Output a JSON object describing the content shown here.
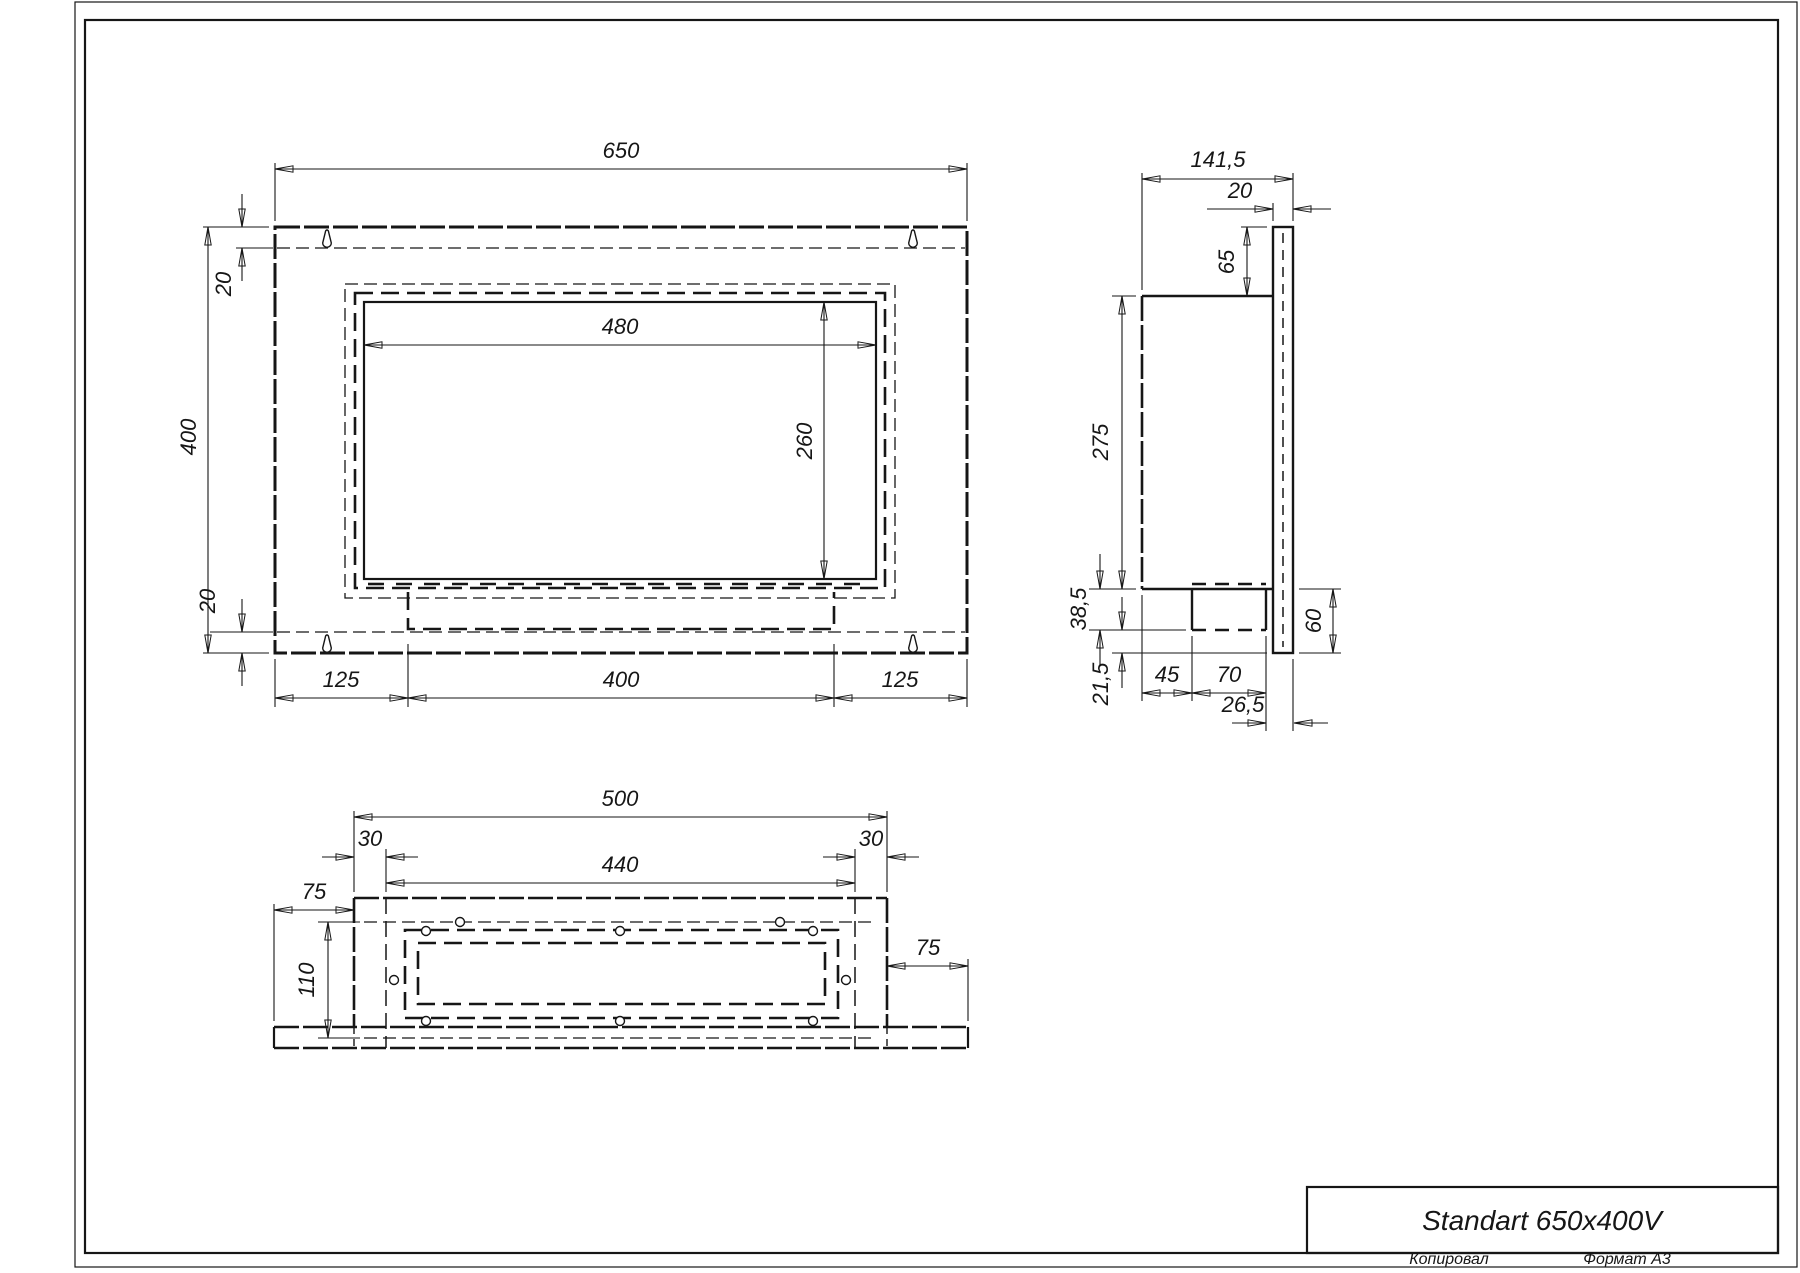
{
  "sheet": {
    "copied_note": "Копировал",
    "format_note": "Формат А3"
  },
  "title_block": {
    "title": "Standart 650x400V"
  },
  "front_view": {
    "width": "650",
    "height": "400",
    "top_offset": "20",
    "bottom_offset": "20",
    "opening_width": "480",
    "opening_height": "260",
    "bottom_left": "125",
    "bottom_center": "400",
    "bottom_right": "125"
  },
  "side_view": {
    "depth": "141,5",
    "flange_thickness": "20",
    "top_to_body": "65",
    "body_height": "275",
    "below_body": "38,5",
    "foot": "21,5",
    "burner_offset": "45",
    "burner_depth": "70",
    "burner_to_front": "26,5",
    "bottom_height": "60"
  },
  "top_view": {
    "body_width": "500",
    "wall_left": "30",
    "inner_width": "440",
    "wall_right": "30",
    "wing_left": "75",
    "hole_span": "110",
    "wing_right": "75"
  },
  "colors": {
    "line": "#161616",
    "background": "#ffffff"
  }
}
